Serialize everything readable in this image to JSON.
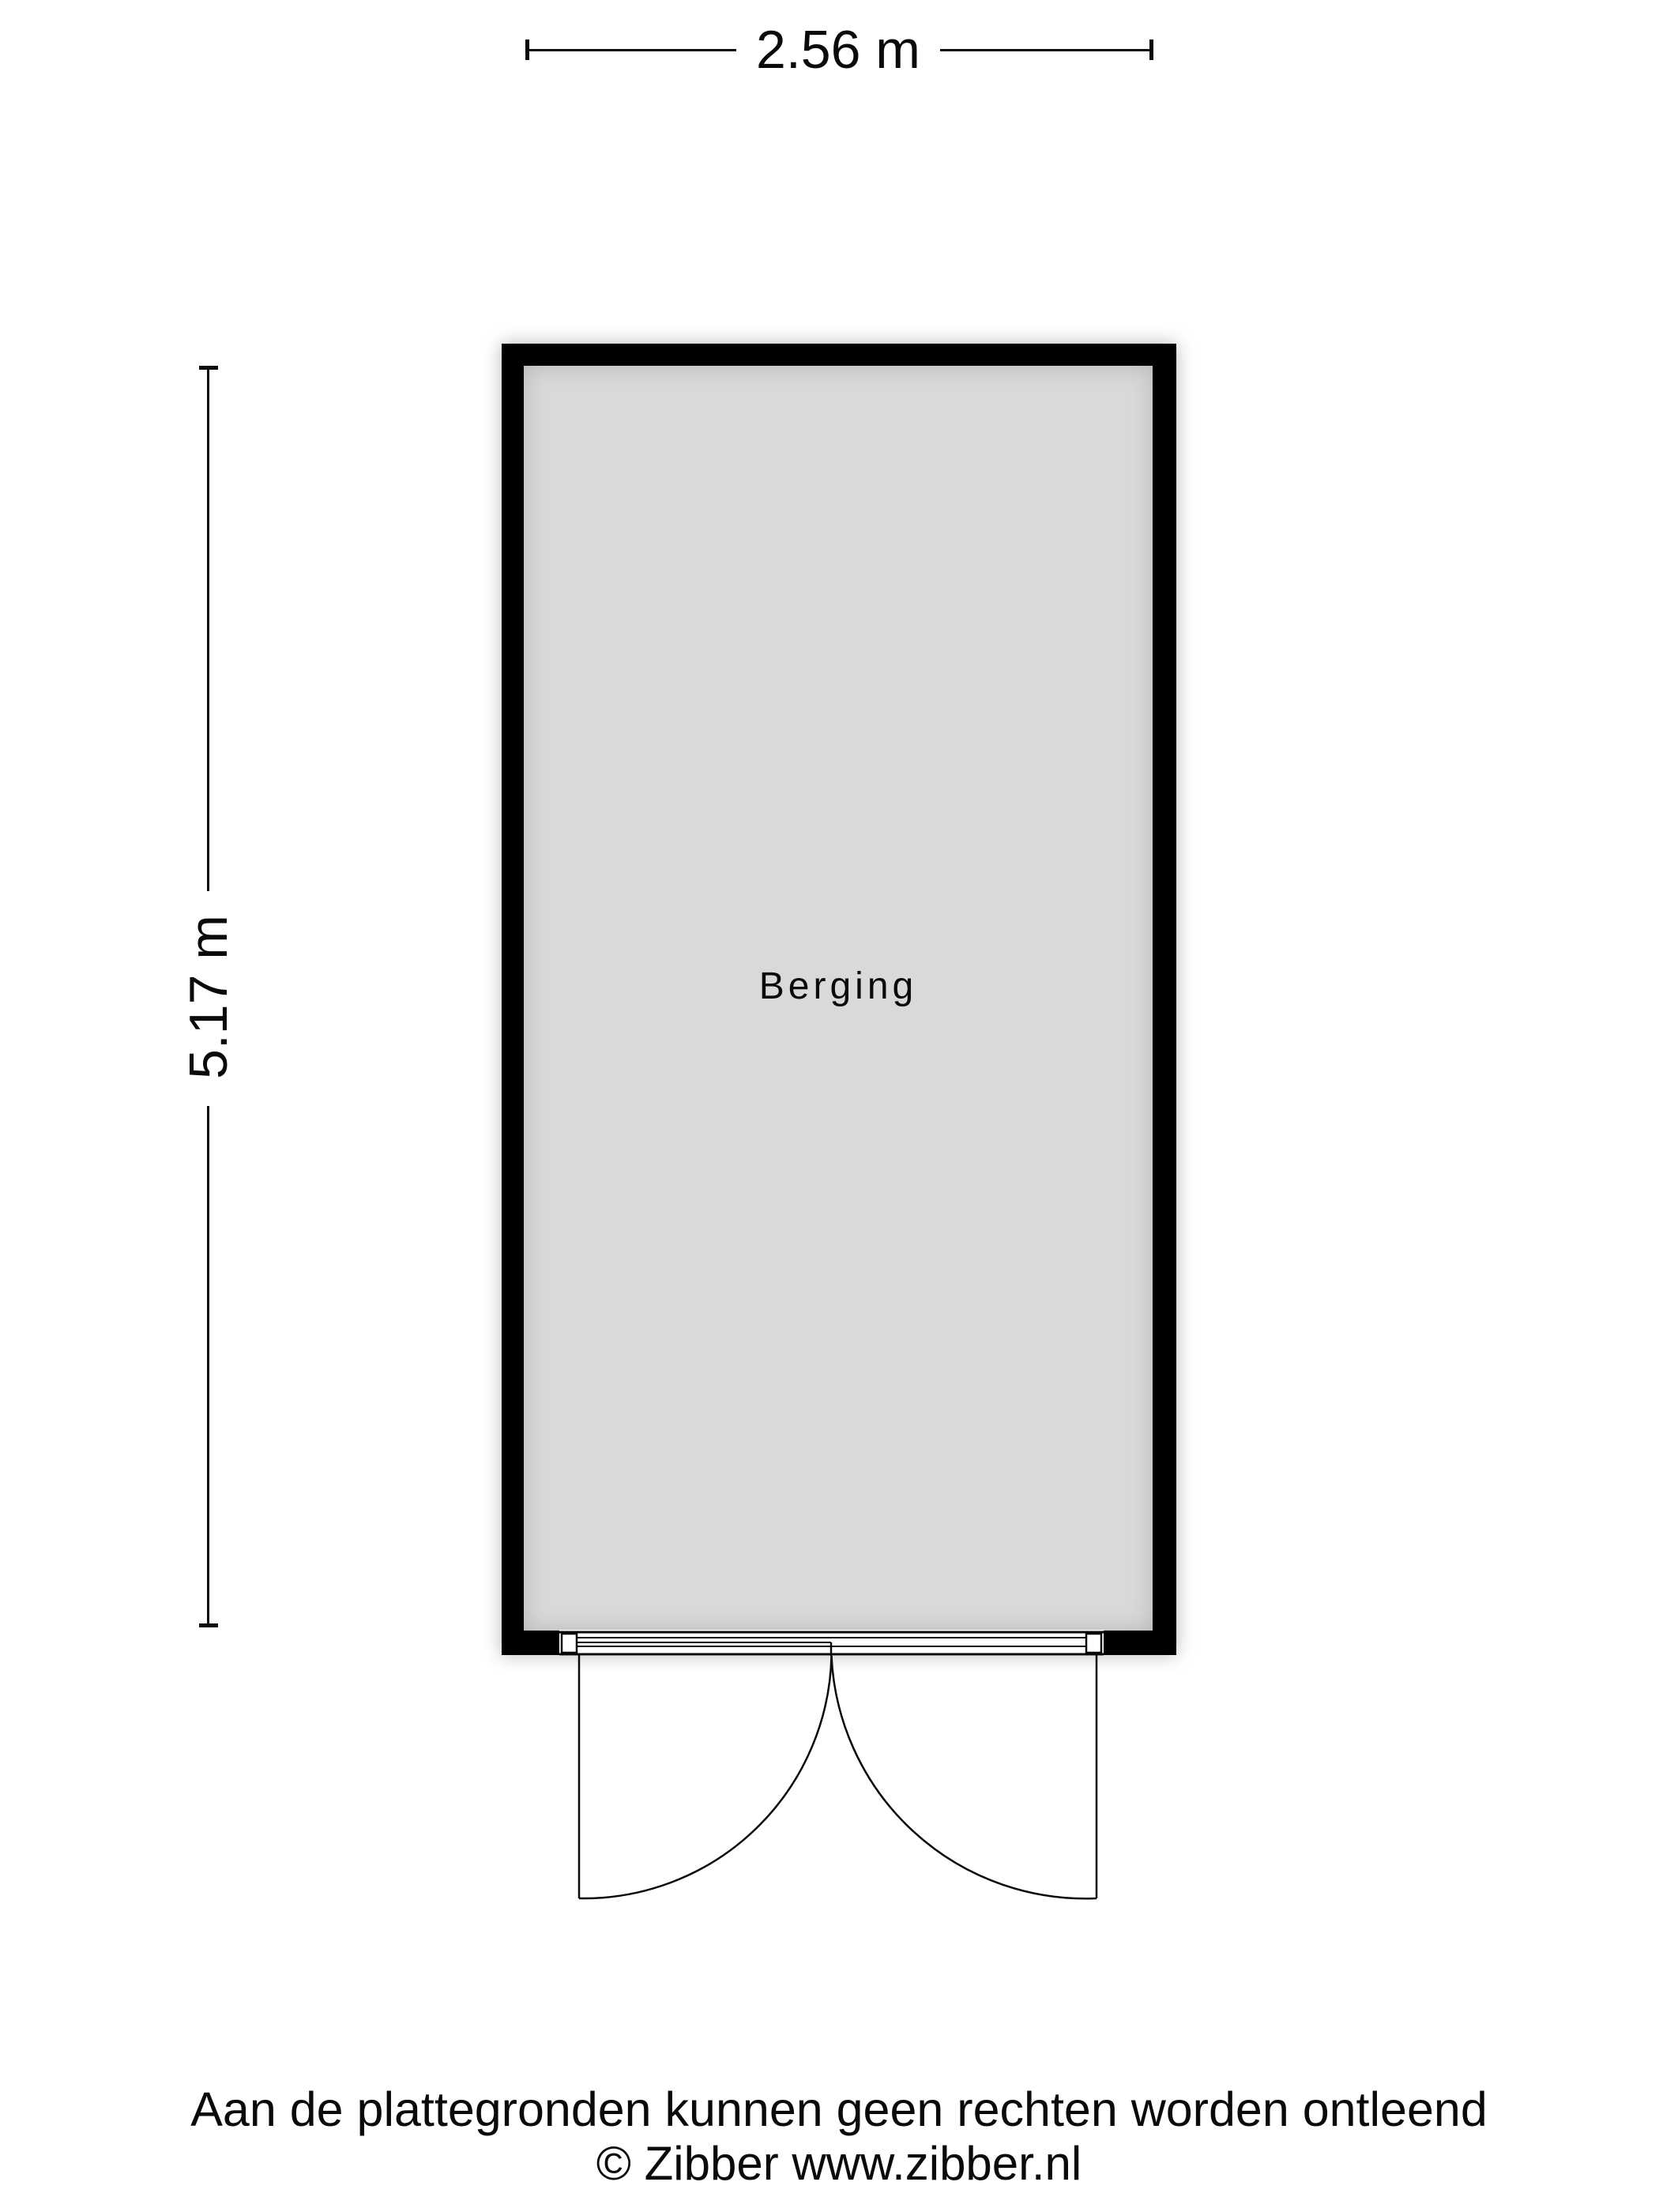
{
  "plan": {
    "room_label": "Berging",
    "width_dimension_label": "2.56 m",
    "height_dimension_label": "5.17 m"
  },
  "footer": {
    "disclaimer": "Aan de plattegronden kunnen geen rechten worden ontleend",
    "copyright": "© Zibber www.zibber.nl"
  },
  "colors": {
    "wall": "#000000",
    "floor": "#d9d9d9",
    "line": "#0a0a0a",
    "background": "#ffffff"
  }
}
